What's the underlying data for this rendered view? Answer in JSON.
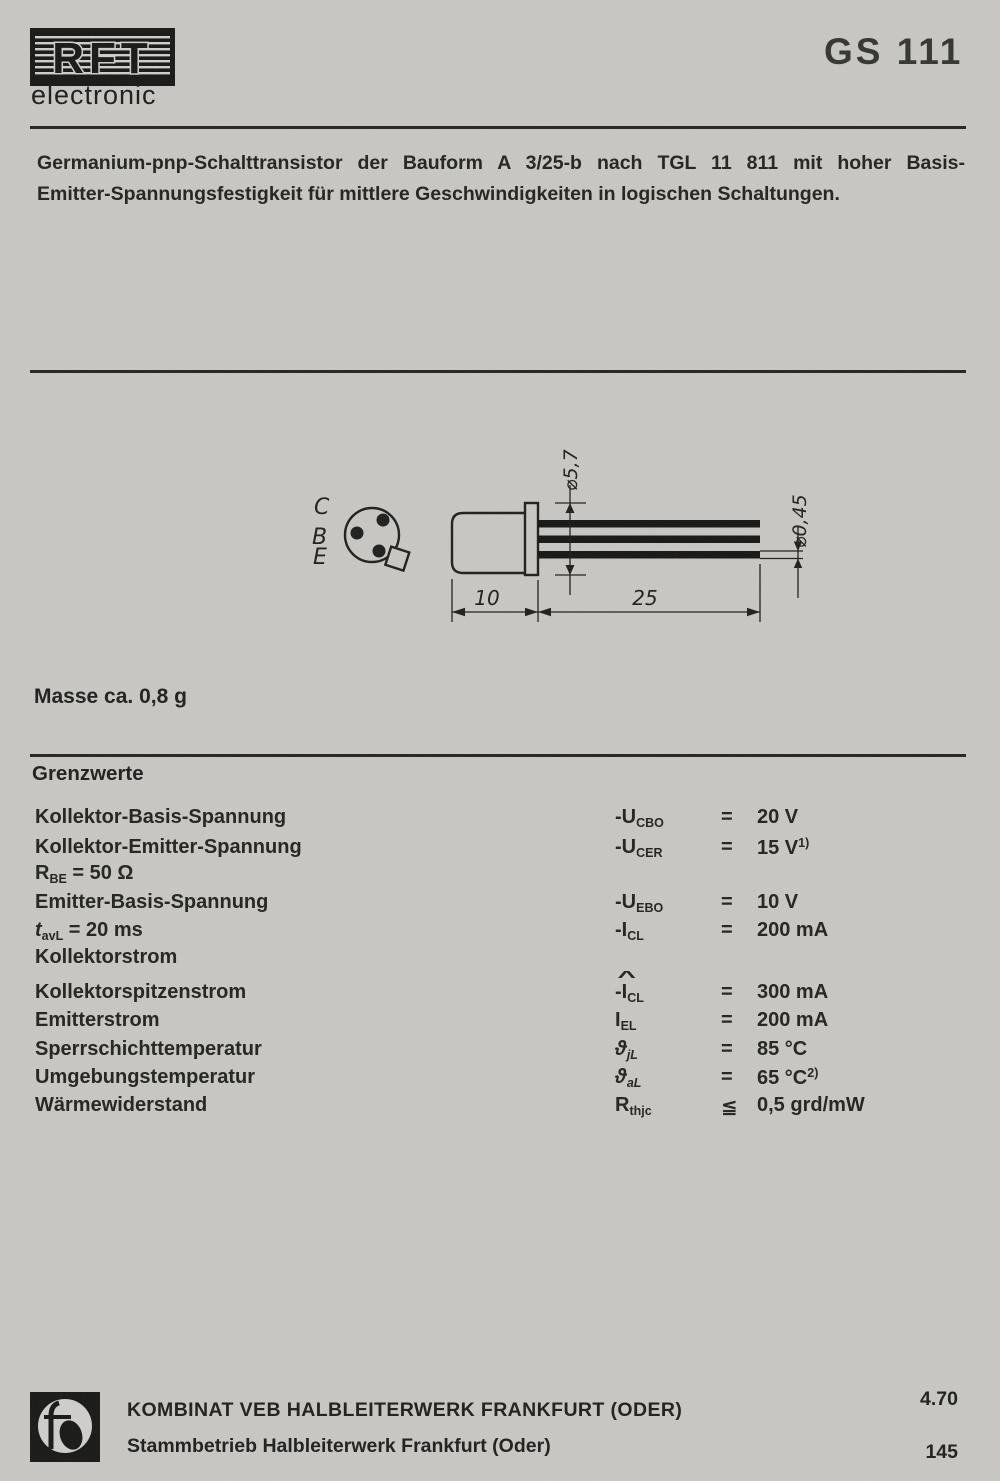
{
  "colors": {
    "paper": "#c8c7c3",
    "ink": "#1d1d1b"
  },
  "header": {
    "brand": "RFT",
    "brand_sub": "electronic",
    "part": "GS 111"
  },
  "intro": {
    "line1": "Germanium-pnp-Schalttransistor der Bauform A 3/25-b nach TGL 11 811 mit hoher Basis-",
    "line2": "Emitter-Spannungsfestigkeit für mittlere Geschwindigkeiten in logischen Schaltungen."
  },
  "drawing": {
    "pins": {
      "c": "C",
      "b": "B",
      "e": "E"
    },
    "dims": {
      "cap_diameter": "⌀5,7",
      "lead_diameter": "⌀0,45",
      "body_length": "10",
      "lead_length": "25"
    }
  },
  "mass_note": "Masse ca. 0,8 g",
  "limits": {
    "heading": "Grenzwerte",
    "rows": [
      {
        "label": "Kollektor-Basis-Spannung",
        "sym": "-U",
        "sub": "CBO",
        "rel": "=",
        "val": "20 V"
      },
      {
        "label": "Kollektor-Emitter-Spannung",
        "sym": "-U",
        "sub": "CER",
        "rel": "=",
        "val": "15 V",
        "sup": "1)"
      },
      {
        "label": "R",
        "lsub": "BE",
        "lrest": " = 50 Ω"
      },
      {
        "label": "Emitter-Basis-Spannung",
        "sym": "-U",
        "sub": "EBO",
        "rel": "=",
        "val": "10 V"
      },
      {
        "label": "t",
        "lsub": "avL",
        "lrest": " = 20 ms",
        "sym": "-I",
        "sub": "CL",
        "rel": "=",
        "val": "200 mA"
      },
      {
        "label": "Kollektorstrom"
      },
      {
        "label": "Kollektorspitzenstrom",
        "hat": "^",
        "sym": "-I",
        "sub": "CL",
        "rel": "=",
        "val": "300 mA"
      },
      {
        "label": "Emitterstrom",
        "sym": "I",
        "sub": "EL",
        "rel": "=",
        "val": "200 mA"
      },
      {
        "label": "Sperrschichttemperatur",
        "sym": "ϑ",
        "sub": "jL",
        "rel": "=",
        "val": "85 °C"
      },
      {
        "label": "Umgebungstemperatur",
        "sym": "ϑ",
        "sub": "aL",
        "rel": "=",
        "val": "65 °C",
        "sup": "2)"
      },
      {
        "label": "Wärmewiderstand",
        "sym": "R",
        "sub": "thjc",
        "rel": "≦",
        "val": "0,5 grd/mW"
      }
    ]
  },
  "footer": {
    "line1": "KOMBINAT VEB HALBLEITERWERK FRANKFURT (ODER)",
    "line2": "Stammbetrieb Halbleiterwerk Frankfurt (Oder)",
    "issue": "4.70",
    "page": "145"
  }
}
